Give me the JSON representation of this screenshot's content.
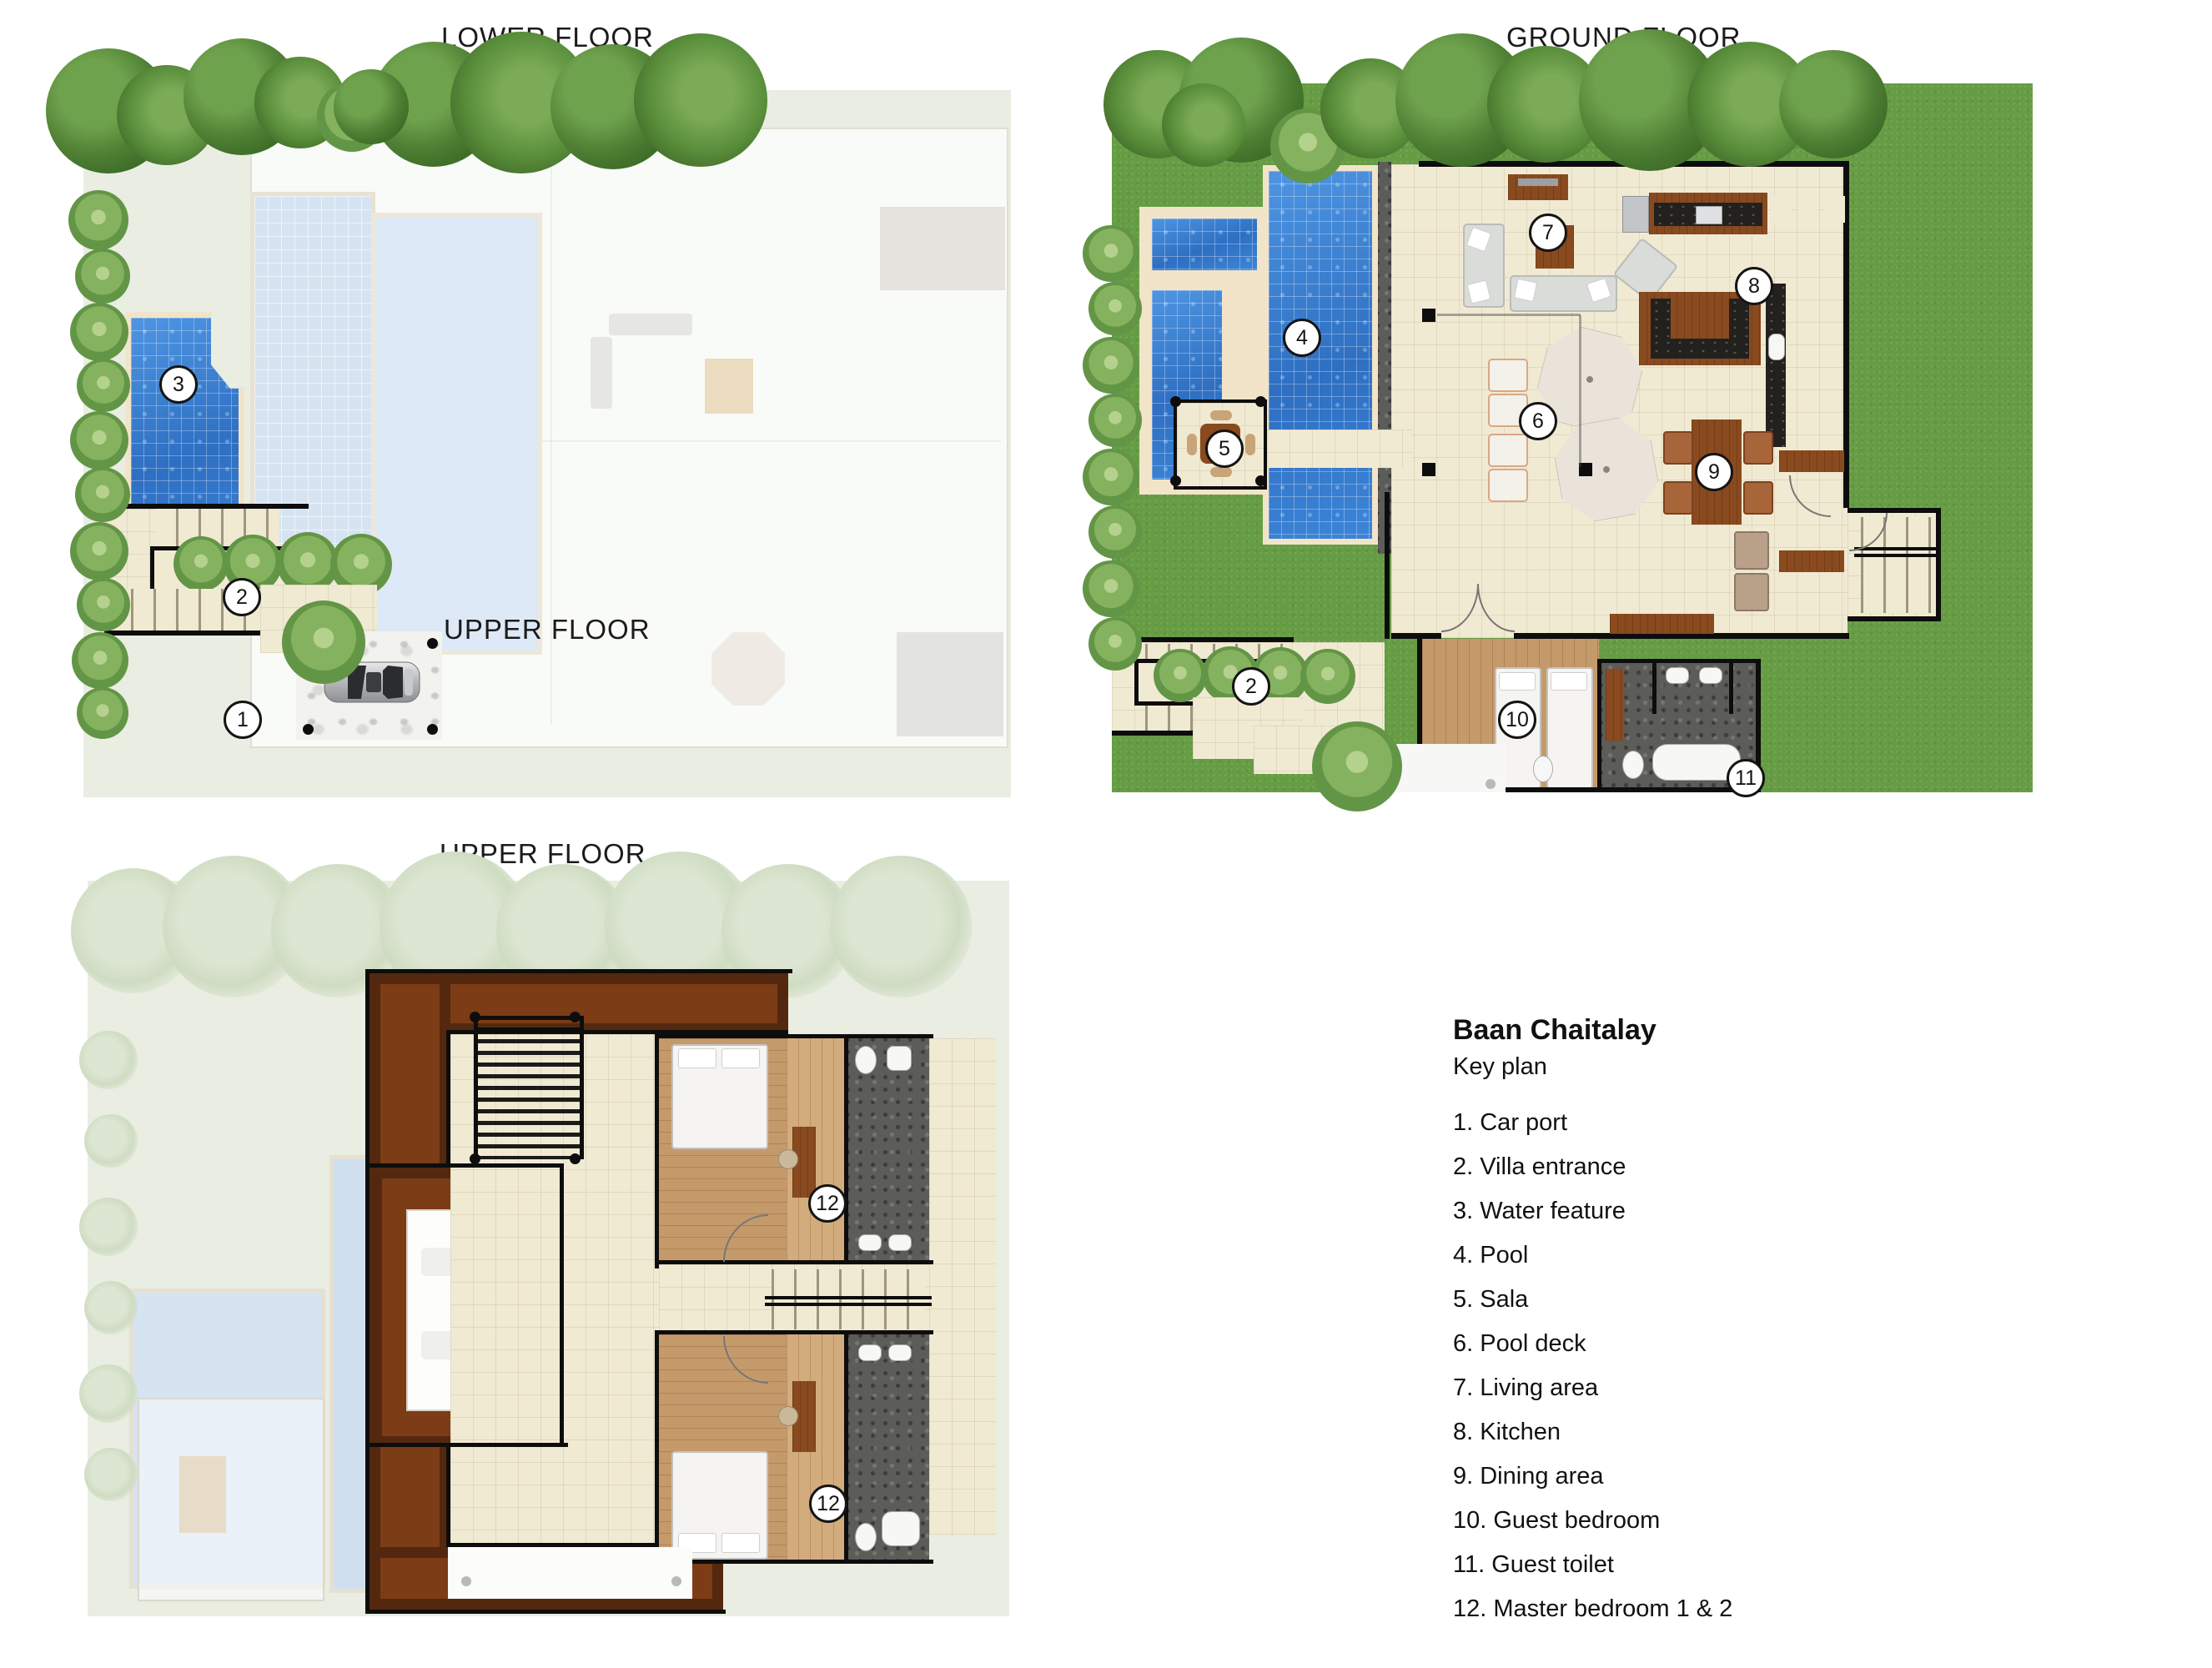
{
  "titles": {
    "lower": "LOWER FLOOR",
    "ground": "GROUND FLOOR",
    "upper": "UPPER FLOOR",
    "upper_inset": "UPPER FLOOR"
  },
  "keyplan": {
    "title": "Baan Chaitalay",
    "subtitle": "Key plan",
    "items": [
      "1. Car port",
      "2. Villa entrance",
      "3. Water feature",
      "4. Pool",
      "5. Sala",
      "6. Pool deck",
      "7. Living area",
      "8. Kitchen",
      "9. Dining area",
      "10. Guest bedroom",
      "11. Guest toilet",
      "12. Master bedroom 1 & 2"
    ]
  },
  "markers": {
    "car_port": "1",
    "villa_entrance_lower": "2",
    "water_feature": "3",
    "villa_entrance_ground": "2",
    "pool": "4",
    "sala": "5",
    "pool_deck": "6",
    "living_area": "7",
    "kitchen": "8",
    "dining_area": "9",
    "guest_bedroom": "10",
    "guest_toilet": "11",
    "master_bedroom_1": "12",
    "master_bedroom_2": "12"
  },
  "colors": {
    "grass": "#669c44",
    "pool_water": "#3b82d4",
    "ghost_water": "#d6e3f1",
    "floor_tile": "#f1ead3",
    "wood_floor": "#c59a6b",
    "roof_brown": "#7b3c16",
    "stone_grey": "#5c5c58",
    "panel_green": "#e9ede2",
    "wall_black": "#0d0d0d"
  }
}
